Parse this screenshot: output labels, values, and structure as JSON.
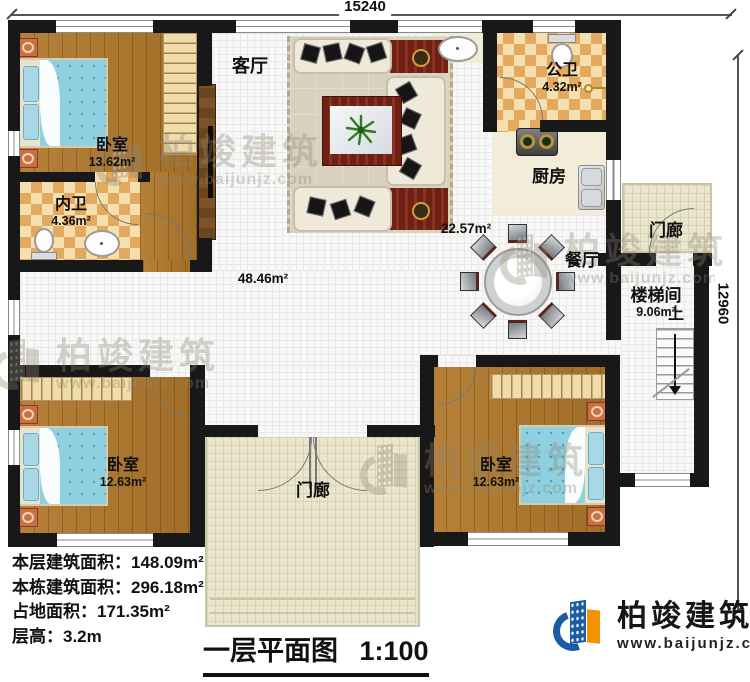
{
  "dimensions": {
    "top": "15240",
    "right": "12960"
  },
  "rooms": {
    "living": {
      "name": "客厅"
    },
    "bedroom_tl": {
      "name": "卧室",
      "area": "13.62m²"
    },
    "bath_inner": {
      "name": "内卫",
      "area": "4.36m²"
    },
    "bath_public": {
      "name": "公卫",
      "area": "4.32m²"
    },
    "kitchen": {
      "name": "厨房"
    },
    "dining": {
      "name": "餐厅",
      "area": "22.57m²"
    },
    "hall": {
      "area": "48.46m²"
    },
    "stairwell": {
      "name": "楼梯间",
      "area": "9.06m²",
      "up": "上"
    },
    "porch_right": {
      "name": "门廊"
    },
    "porch_bottom": {
      "name": "门廊"
    },
    "bedroom_bl": {
      "name": "卧室",
      "area": "12.63m²"
    },
    "bedroom_br": {
      "name": "卧室",
      "area": "12.63m²"
    }
  },
  "info": {
    "lines": [
      "本层建筑面积：148.09m²",
      "本栋建筑面积：296.18m²",
      "占地面积：171.35m²",
      "层高：3.2m"
    ]
  },
  "title": {
    "text": "一层平面图",
    "scale": "1:100"
  },
  "brand": {
    "name": "柏竣建筑",
    "url": "www.baijunjz.com"
  },
  "watermark": {
    "name": "柏竣建筑",
    "url": "www.baijunjz.com"
  },
  "colors": {
    "wall": "#181818",
    "wood_floor": "#ab772f",
    "tile_light": "#f6dfae",
    "tile_dark": "#e3aa5f",
    "hall_tile": "#f8f8f6",
    "porch_floor": "#eae6cd",
    "bed_blue": "#8fd0e0",
    "accent_red": "#6e2014",
    "logo_blue": "#1a5ca5",
    "logo_orange": "#f29200"
  }
}
